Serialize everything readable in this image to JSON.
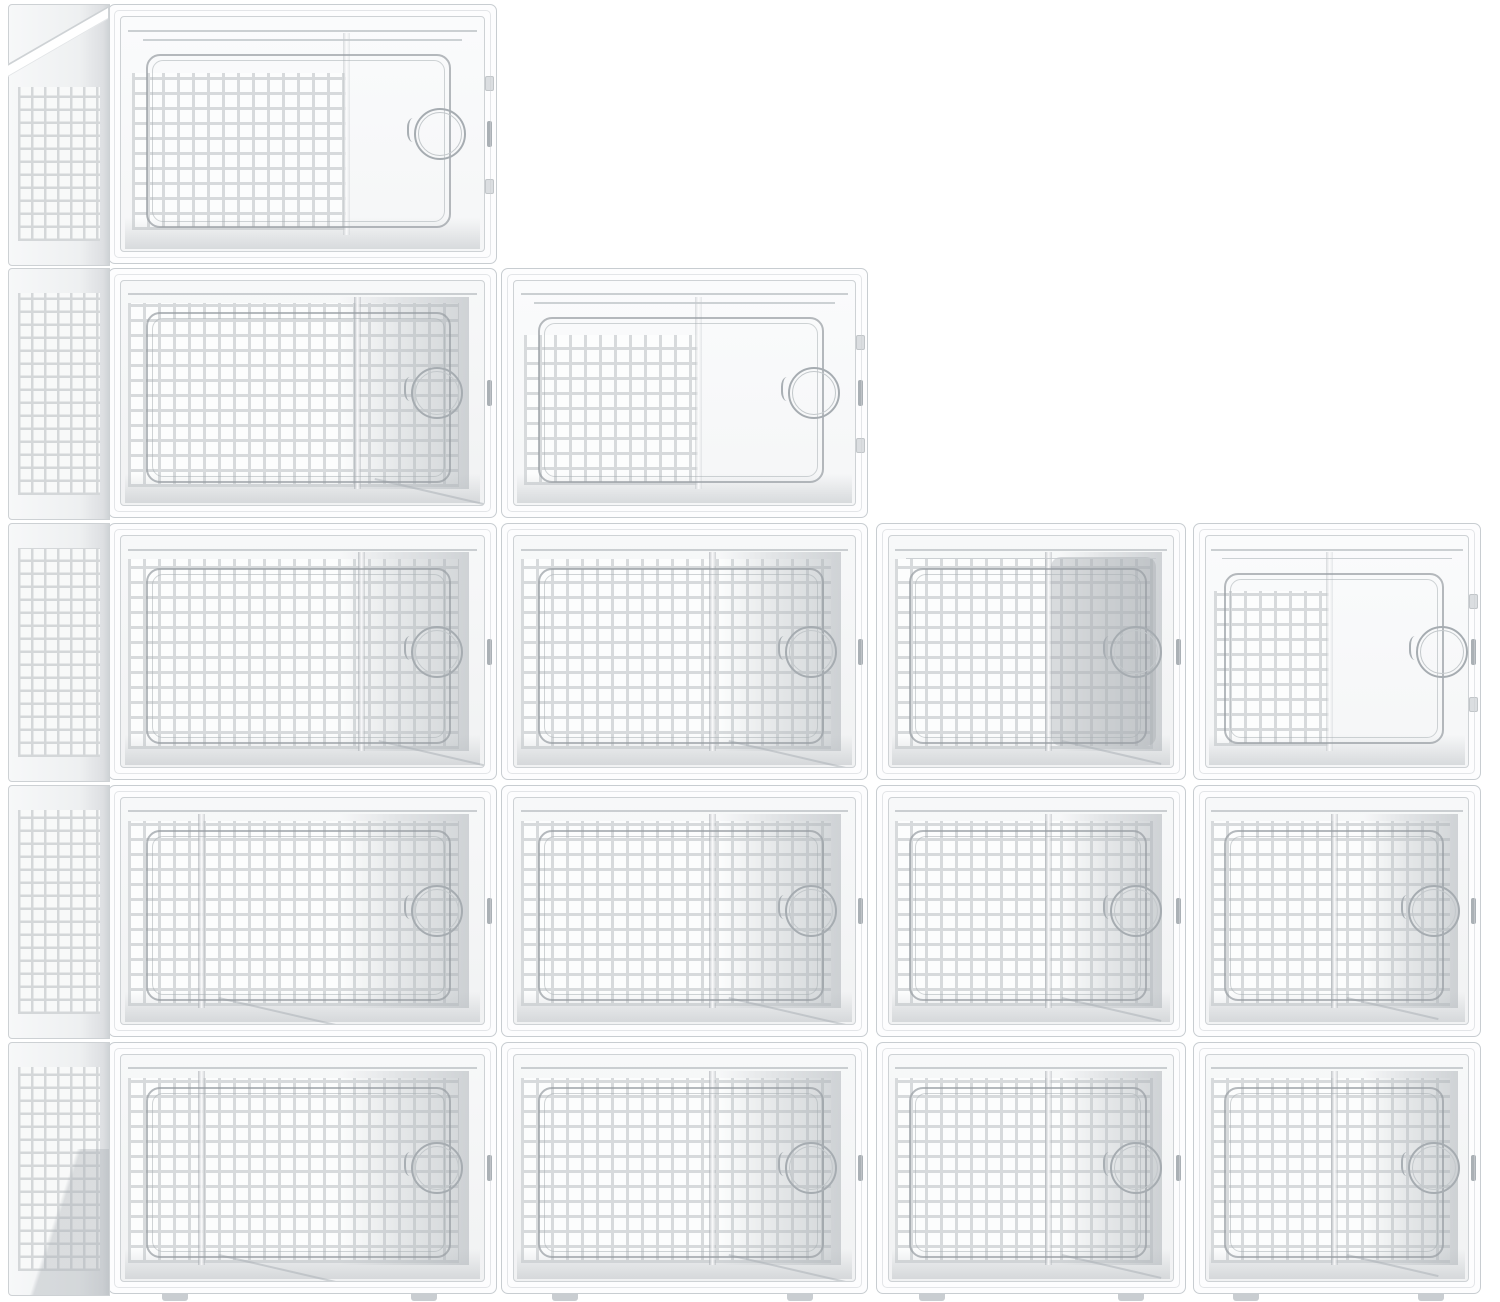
{
  "meta": {
    "description": "Product photo on a white background: fifteen clear stackable plastic shoe storage boxes with white frames, perforated square-hole front doors and round pull handles, stacked in a descending staircase of four columns (5, 4, 3 and 3 boxes tall). No text appears in the image.",
    "background": "#ffffff"
  },
  "palette": {
    "frame_white": "#fdfdfe",
    "frame_line": "#c8cdd1",
    "grid_line": "#d7dadc",
    "grid_hole": "#fcfdfd",
    "interior_light": "#f4f5f6",
    "shadow_gray": "#b9bec3",
    "dark_panel": "#a6acb1",
    "handle_ring": "#a6acb1"
  },
  "pattern": {
    "front_pitch_px": 15,
    "front_line_px": 3,
    "side_pitch_px": 13,
    "side_line_px": 2.5
  },
  "layout": {
    "rows": [
      {
        "y": 4,
        "h": 260
      },
      {
        "y": 268,
        "h": 250
      },
      {
        "y": 523,
        "h": 257
      },
      {
        "y": 785,
        "h": 252
      },
      {
        "y": 1042,
        "h": 252
      }
    ],
    "columns": [
      {
        "x": 108,
        "w": 389,
        "side": {
          "x": 8,
          "w": 100
        },
        "top_face": true
      },
      {
        "x": 501,
        "w": 367
      },
      {
        "x": 876,
        "w": 310
      },
      {
        "x": 1193,
        "w": 288
      }
    ],
    "boxes": [
      {
        "col": 0,
        "row": 0,
        "variant": "open",
        "handle": 0.88,
        "grid_right": 0.62,
        "lid": true
      },
      {
        "col": 0,
        "row": 1,
        "variant": "closed",
        "handle": 0.87,
        "divider": 0.65
      },
      {
        "col": 0,
        "row": 2,
        "variant": "closed",
        "handle": 0.87,
        "divider": 0.66
      },
      {
        "col": 0,
        "row": 3,
        "variant": "closed",
        "handle": 0.87,
        "divider": 0.22
      },
      {
        "col": 0,
        "row": 4,
        "variant": "closed",
        "handle": 0.87,
        "divider": 0.22
      },
      {
        "col": 1,
        "row": 1,
        "variant": "open",
        "handle": 0.88,
        "grid_right": 0.54,
        "lid": true
      },
      {
        "col": 1,
        "row": 2,
        "variant": "closed",
        "handle": 0.87,
        "divider": 0.58
      },
      {
        "col": 1,
        "row": 3,
        "variant": "closed",
        "handle": 0.87,
        "divider": 0.58
      },
      {
        "col": 1,
        "row": 4,
        "variant": "closed",
        "handle": 0.87,
        "divider": 0.58
      },
      {
        "col": 2,
        "row": 2,
        "variant": "dark",
        "handle": 0.87,
        "divider": 0.56,
        "lid": true
      },
      {
        "col": 2,
        "row": 3,
        "variant": "closed",
        "handle": 0.87,
        "divider": 0.56
      },
      {
        "col": 2,
        "row": 4,
        "variant": "closed",
        "handle": 0.87,
        "divider": 0.56
      },
      {
        "col": 3,
        "row": 2,
        "variant": "open",
        "handle": 0.9,
        "grid_right": 0.47,
        "lid": true
      },
      {
        "col": 3,
        "row": 3,
        "variant": "closed",
        "handle": 0.87,
        "divider": 0.49
      },
      {
        "col": 3,
        "row": 4,
        "variant": "closed",
        "handle": 0.87,
        "divider": 0.49
      }
    ]
  }
}
